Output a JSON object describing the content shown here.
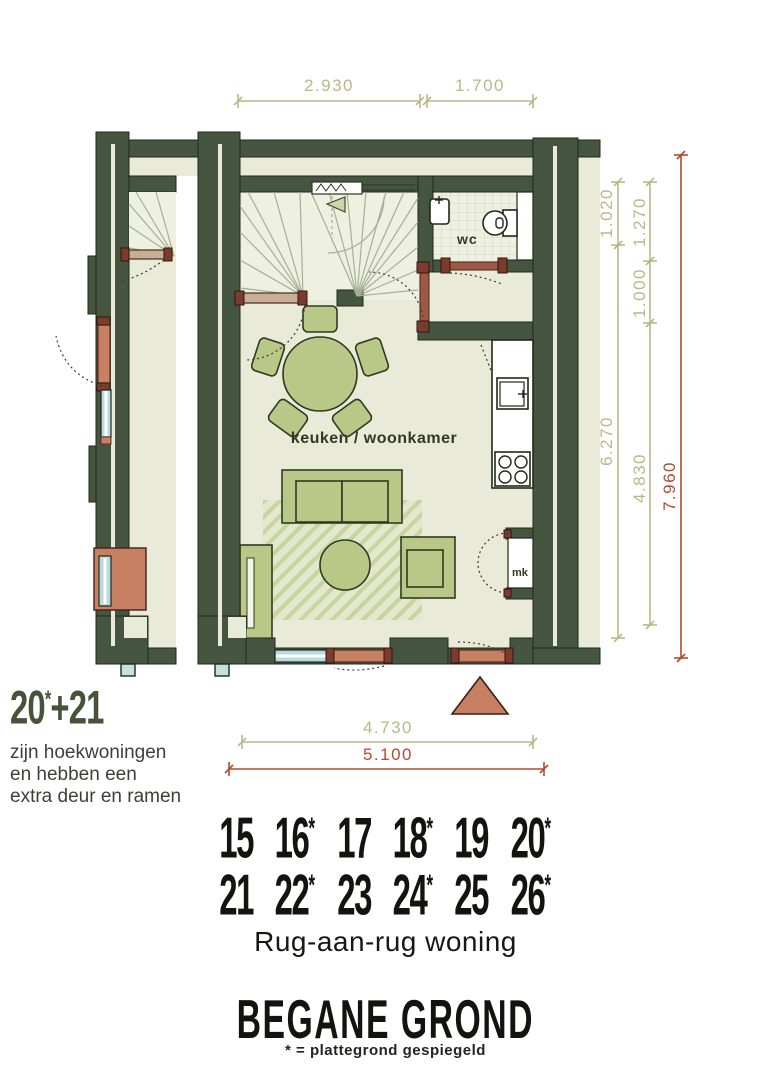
{
  "plan": {
    "dimensions": {
      "top": [
        "2.930",
        "1.700"
      ],
      "right_inner": [
        "1.020",
        "6.270"
      ],
      "right_middle": [
        "1.270",
        "1.000",
        "4.830"
      ],
      "right_total": "7.960",
      "bottom_inner": "4.730",
      "bottom_total": "5.100"
    },
    "rooms": {
      "wc": "wc",
      "living": "keuken / woonkamer",
      "meter_closet": "mk"
    },
    "colors": {
      "wall": "#465540",
      "floor": "#e9ebd8",
      "furniture": "#b9c887",
      "door": "#c88063",
      "window": "#b9dae2",
      "dim_olive": "#b6ba87",
      "dim_red": "#b3492f"
    }
  },
  "note": {
    "num": "20",
    "star": "*",
    "rest": "+21",
    "lines": [
      "zijn hoekwoningen",
      "en hebben een",
      "extra deur en ramen"
    ]
  },
  "units": {
    "row1": [
      {
        "n": "15",
        "star": false
      },
      {
        "n": "16",
        "star": true
      },
      {
        "n": "17",
        "star": false
      },
      {
        "n": "18",
        "star": true
      },
      {
        "n": "19",
        "star": false
      },
      {
        "n": "20",
        "star": true
      }
    ],
    "row2": [
      {
        "n": "21",
        "star": false
      },
      {
        "n": "22",
        "star": true
      },
      {
        "n": "23",
        "star": false
      },
      {
        "n": "24",
        "star": true
      },
      {
        "n": "25",
        "star": false
      },
      {
        "n": "26",
        "star": true
      }
    ]
  },
  "type_label": "Rug-aan-rug woning",
  "floor": {
    "title": "BEGANE GROND",
    "legend": "* = plattegrond gespiegeld"
  }
}
